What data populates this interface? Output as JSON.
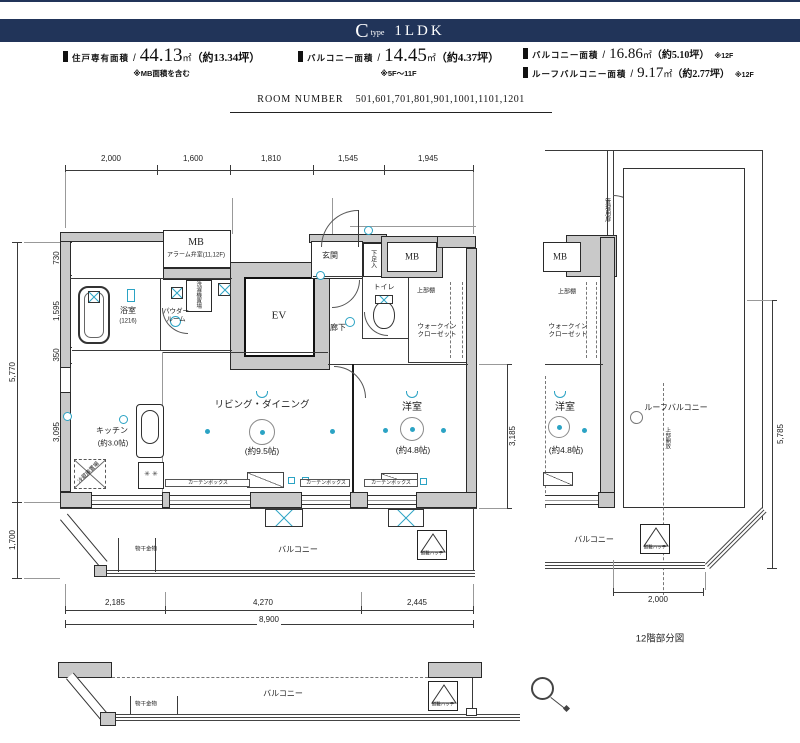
{
  "colors": {
    "banner_bg": "#213459",
    "fixture_cyan": "#2ba3c4",
    "wall_gray": "#c9c9c9",
    "line": "#333333"
  },
  "banner": {
    "letter": "C",
    "word": "type",
    "plan": "1LDK"
  },
  "areas": [
    {
      "label": "住戸専有面積",
      "slash": "/",
      "value": "44.13",
      "unit": "㎡",
      "tsubo": "（約13.34坪）",
      "note": "※MB面積を含む"
    },
    {
      "label": "バルコニー面積",
      "slash": "/",
      "value": "14.45",
      "unit": "㎡",
      "tsubo": "（約4.37坪）",
      "note": "※5F～11F"
    },
    {
      "label": "バルコニー面積",
      "slash": "/",
      "value": "16.86",
      "unit": "㎡",
      "tsubo": "（約5.10坪）",
      "note": "※12F"
    },
    {
      "label": "ルーフバルコニー面積",
      "slash": "/",
      "value": "9.17",
      "unit": "㎡",
      "tsubo": "（約2.77坪）",
      "note": "※12F"
    }
  ],
  "room_number": {
    "label": "ROOM NUMBER",
    "numbers": "501,601,701,801,901,1001,1101,1201"
  },
  "icons": {
    "area-bullet-icon": "▮",
    "north-arrow-icon": "circle-with-tail",
    "evacuation-hatch-icon": "triangle-in-box",
    "stove-icon": "✳"
  },
  "drawing_labels": [
    {
      "n": "dim-top-2000",
      "t": "2,000",
      "x": 111,
      "y": 159,
      "s": 8
    },
    {
      "n": "dim-top-1600",
      "t": "1,600",
      "x": 193,
      "y": 159,
      "s": 8
    },
    {
      "n": "dim-top-1810",
      "t": "1,810",
      "x": 271,
      "y": 159,
      "s": 8
    },
    {
      "n": "dim-top-1545",
      "t": "1,545",
      "x": 348,
      "y": 159,
      "s": 8
    },
    {
      "n": "dim-top-1945",
      "t": "1,945",
      "x": 428,
      "y": 159,
      "s": 8
    },
    {
      "n": "dim-left-730",
      "t": "730",
      "x": 57,
      "y": 258,
      "s": 8,
      "r": -90
    },
    {
      "n": "dim-left-1595",
      "t": "1,595",
      "x": 57,
      "y": 311,
      "s": 8,
      "r": -90
    },
    {
      "n": "dim-left-350",
      "t": "350",
      "x": 57,
      "y": 355,
      "s": 8,
      "r": -90
    },
    {
      "n": "dim-left-3095",
      "t": "3,095",
      "x": 57,
      "y": 432,
      "s": 8,
      "r": -90
    },
    {
      "n": "dim-left-5770",
      "t": "5,770",
      "x": 13,
      "y": 372,
      "s": 8,
      "r": -90
    },
    {
      "n": "dim-left-1700",
      "t": "1,700",
      "x": 13,
      "y": 540,
      "s": 8,
      "r": -90
    },
    {
      "n": "dim-right-3185",
      "t": "3,185",
      "x": 513,
      "y": 436,
      "s": 8,
      "r": -90
    },
    {
      "n": "dim-bottom-2185",
      "t": "2,185",
      "x": 115,
      "y": 603,
      "s": 8
    },
    {
      "n": "dim-bottom-4270",
      "t": "4,270",
      "x": 263,
      "y": 603,
      "s": 8
    },
    {
      "n": "dim-bottom-2445",
      "t": "2,445",
      "x": 417,
      "y": 603,
      "s": 8
    },
    {
      "n": "dim-bottom-8900",
      "t": "8,900",
      "x": 269,
      "y": 620,
      "s": 8,
      "b": 1
    },
    {
      "n": "dim-rightplan-5785",
      "t": "5,785",
      "x": 781,
      "y": 434,
      "s": 8,
      "r": -90
    },
    {
      "n": "dim-rightplan-2000",
      "t": "2,000",
      "x": 658,
      "y": 600,
      "s": 8,
      "b": 1
    },
    {
      "n": "label-mb-alarm",
      "t": "MB",
      "x": 196,
      "y": 243,
      "s": 10,
      "f": 1
    },
    {
      "n": "label-mb-alarm-sub",
      "t": "アラーム弁室(11,12F)",
      "x": 196,
      "y": 256,
      "s": 6
    },
    {
      "n": "label-genkan",
      "t": "玄関",
      "x": 330,
      "y": 256,
      "s": 8
    },
    {
      "n": "label-shoe-box",
      "t": "下足入",
      "x": 372,
      "y": 259,
      "s": 6,
      "v": 1
    },
    {
      "n": "label-mb-right",
      "t": "MB",
      "x": 412,
      "y": 257,
      "s": 9,
      "f": 1
    },
    {
      "n": "label-elevator",
      "t": "EV",
      "x": 279,
      "y": 316,
      "s": 11,
      "f": 1
    },
    {
      "n": "label-toilet",
      "t": "トイレ",
      "x": 384,
      "y": 288,
      "s": 7
    },
    {
      "n": "label-corridor",
      "t": "廊下",
      "x": 338,
      "y": 328,
      "s": 8
    },
    {
      "n": "label-shelf-1",
      "t": "上部棚",
      "x": 426,
      "y": 292,
      "s": 6
    },
    {
      "n": "label-wic-1",
      "t": "ウォークイン\nクローゼット",
      "x": 437,
      "y": 331,
      "s": 6.5
    },
    {
      "n": "label-bath",
      "t": "浴室",
      "x": 128,
      "y": 311,
      "s": 8
    },
    {
      "n": "label-bath-size",
      "t": "(1216)",
      "x": 128,
      "y": 322,
      "s": 6
    },
    {
      "n": "label-powder-room",
      "t": "パウダー\nルーム",
      "x": 176,
      "y": 316,
      "s": 6.5
    },
    {
      "n": "label-laundry",
      "t": "洗濯機置場",
      "x": 198,
      "y": 295,
      "s": 5.5,
      "v": 1
    },
    {
      "n": "label-living-dining",
      "t": "リビング・ダイニング",
      "x": 262,
      "y": 405,
      "s": 9.5
    },
    {
      "n": "label-living-size",
      "t": "(約9.5帖)",
      "x": 262,
      "y": 451,
      "s": 8.5
    },
    {
      "n": "label-bedroom",
      "t": "洋室",
      "x": 412,
      "y": 408,
      "s": 10
    },
    {
      "n": "label-bedroom-size",
      "t": "(約4.8帖)",
      "x": 413,
      "y": 450,
      "s": 8.5
    },
    {
      "n": "label-kitchen",
      "t": "キッチン",
      "x": 112,
      "y": 431,
      "s": 8
    },
    {
      "n": "label-kitchen-size",
      "t": "(約3.0帖)",
      "x": 113,
      "y": 443,
      "s": 7.5
    },
    {
      "n": "label-fridge",
      "t": "冷蔵庫置場",
      "x": 89,
      "y": 473,
      "s": 5.5,
      "r": -45
    },
    {
      "n": "stove-burner-icons",
      "t": "✳ ✳",
      "x": 151,
      "y": 475,
      "s": 7,
      "c": "#444"
    },
    {
      "n": "label-curtain-box-1",
      "t": "カーテンボックス",
      "x": 208,
      "y": 483,
      "s": 5
    },
    {
      "n": "label-curtain-box-2",
      "t": "カーテンボックス",
      "x": 326,
      "y": 483,
      "s": 5
    },
    {
      "n": "label-curtain-box-3",
      "t": "カーテンボックス",
      "x": 391,
      "y": 483,
      "s": 5
    },
    {
      "n": "label-balcony-main",
      "t": "バルコニー",
      "x": 298,
      "y": 550,
      "s": 8
    },
    {
      "n": "label-monohoshi-1",
      "t": "物干金物",
      "x": 146,
      "y": 550,
      "s": 5.5
    },
    {
      "n": "label-hatch-1",
      "t": "避難ハッチ",
      "x": 432,
      "y": 553,
      "s": 4.5
    },
    {
      "n": "label-kanri-door",
      "t": "管理用扉",
      "x": 606,
      "y": 210,
      "s": 6,
      "v": 1
    },
    {
      "n": "label-mb-rightplan",
      "t": "MB",
      "x": 560,
      "y": 257,
      "s": 9,
      "f": 1
    },
    {
      "n": "label-shelf-2",
      "t": "上部棚",
      "x": 567,
      "y": 293,
      "s": 6
    },
    {
      "n": "label-wic-2",
      "t": "ウォークイン\nクローゼット",
      "x": 568,
      "y": 331,
      "s": 6.5
    },
    {
      "n": "label-bedroom-2",
      "t": "洋室",
      "x": 565,
      "y": 408,
      "s": 10
    },
    {
      "n": "label-bedroom-2-size",
      "t": "(約4.8帖)",
      "x": 566,
      "y": 450,
      "s": 8.5
    },
    {
      "n": "label-roof-balcony",
      "t": "ルーフバルコニー",
      "x": 676,
      "y": 408,
      "s": 8
    },
    {
      "n": "label-open-above",
      "t": "上部開放",
      "x": 667,
      "y": 438,
      "s": 5.5,
      "v": 1
    },
    {
      "n": "label-balcony-rightplan",
      "t": "バルコニー",
      "x": 594,
      "y": 540,
      "s": 8
    },
    {
      "n": "label-hatch-2",
      "t": "避難ハッチ",
      "x": 655,
      "y": 547,
      "s": 4.5
    },
    {
      "n": "label-caption-12f",
      "t": "12階部分図",
      "x": 660,
      "y": 639,
      "s": 9.5
    },
    {
      "n": "label-balcony-bottom",
      "t": "バルコニー",
      "x": 283,
      "y": 694,
      "s": 8
    },
    {
      "n": "label-monohoshi-2",
      "t": "物干金物",
      "x": 146,
      "y": 705,
      "s": 5.5
    },
    {
      "n": "label-hatch-3",
      "t": "避難ハッチ",
      "x": 443,
      "y": 704,
      "s": 4.5
    }
  ]
}
